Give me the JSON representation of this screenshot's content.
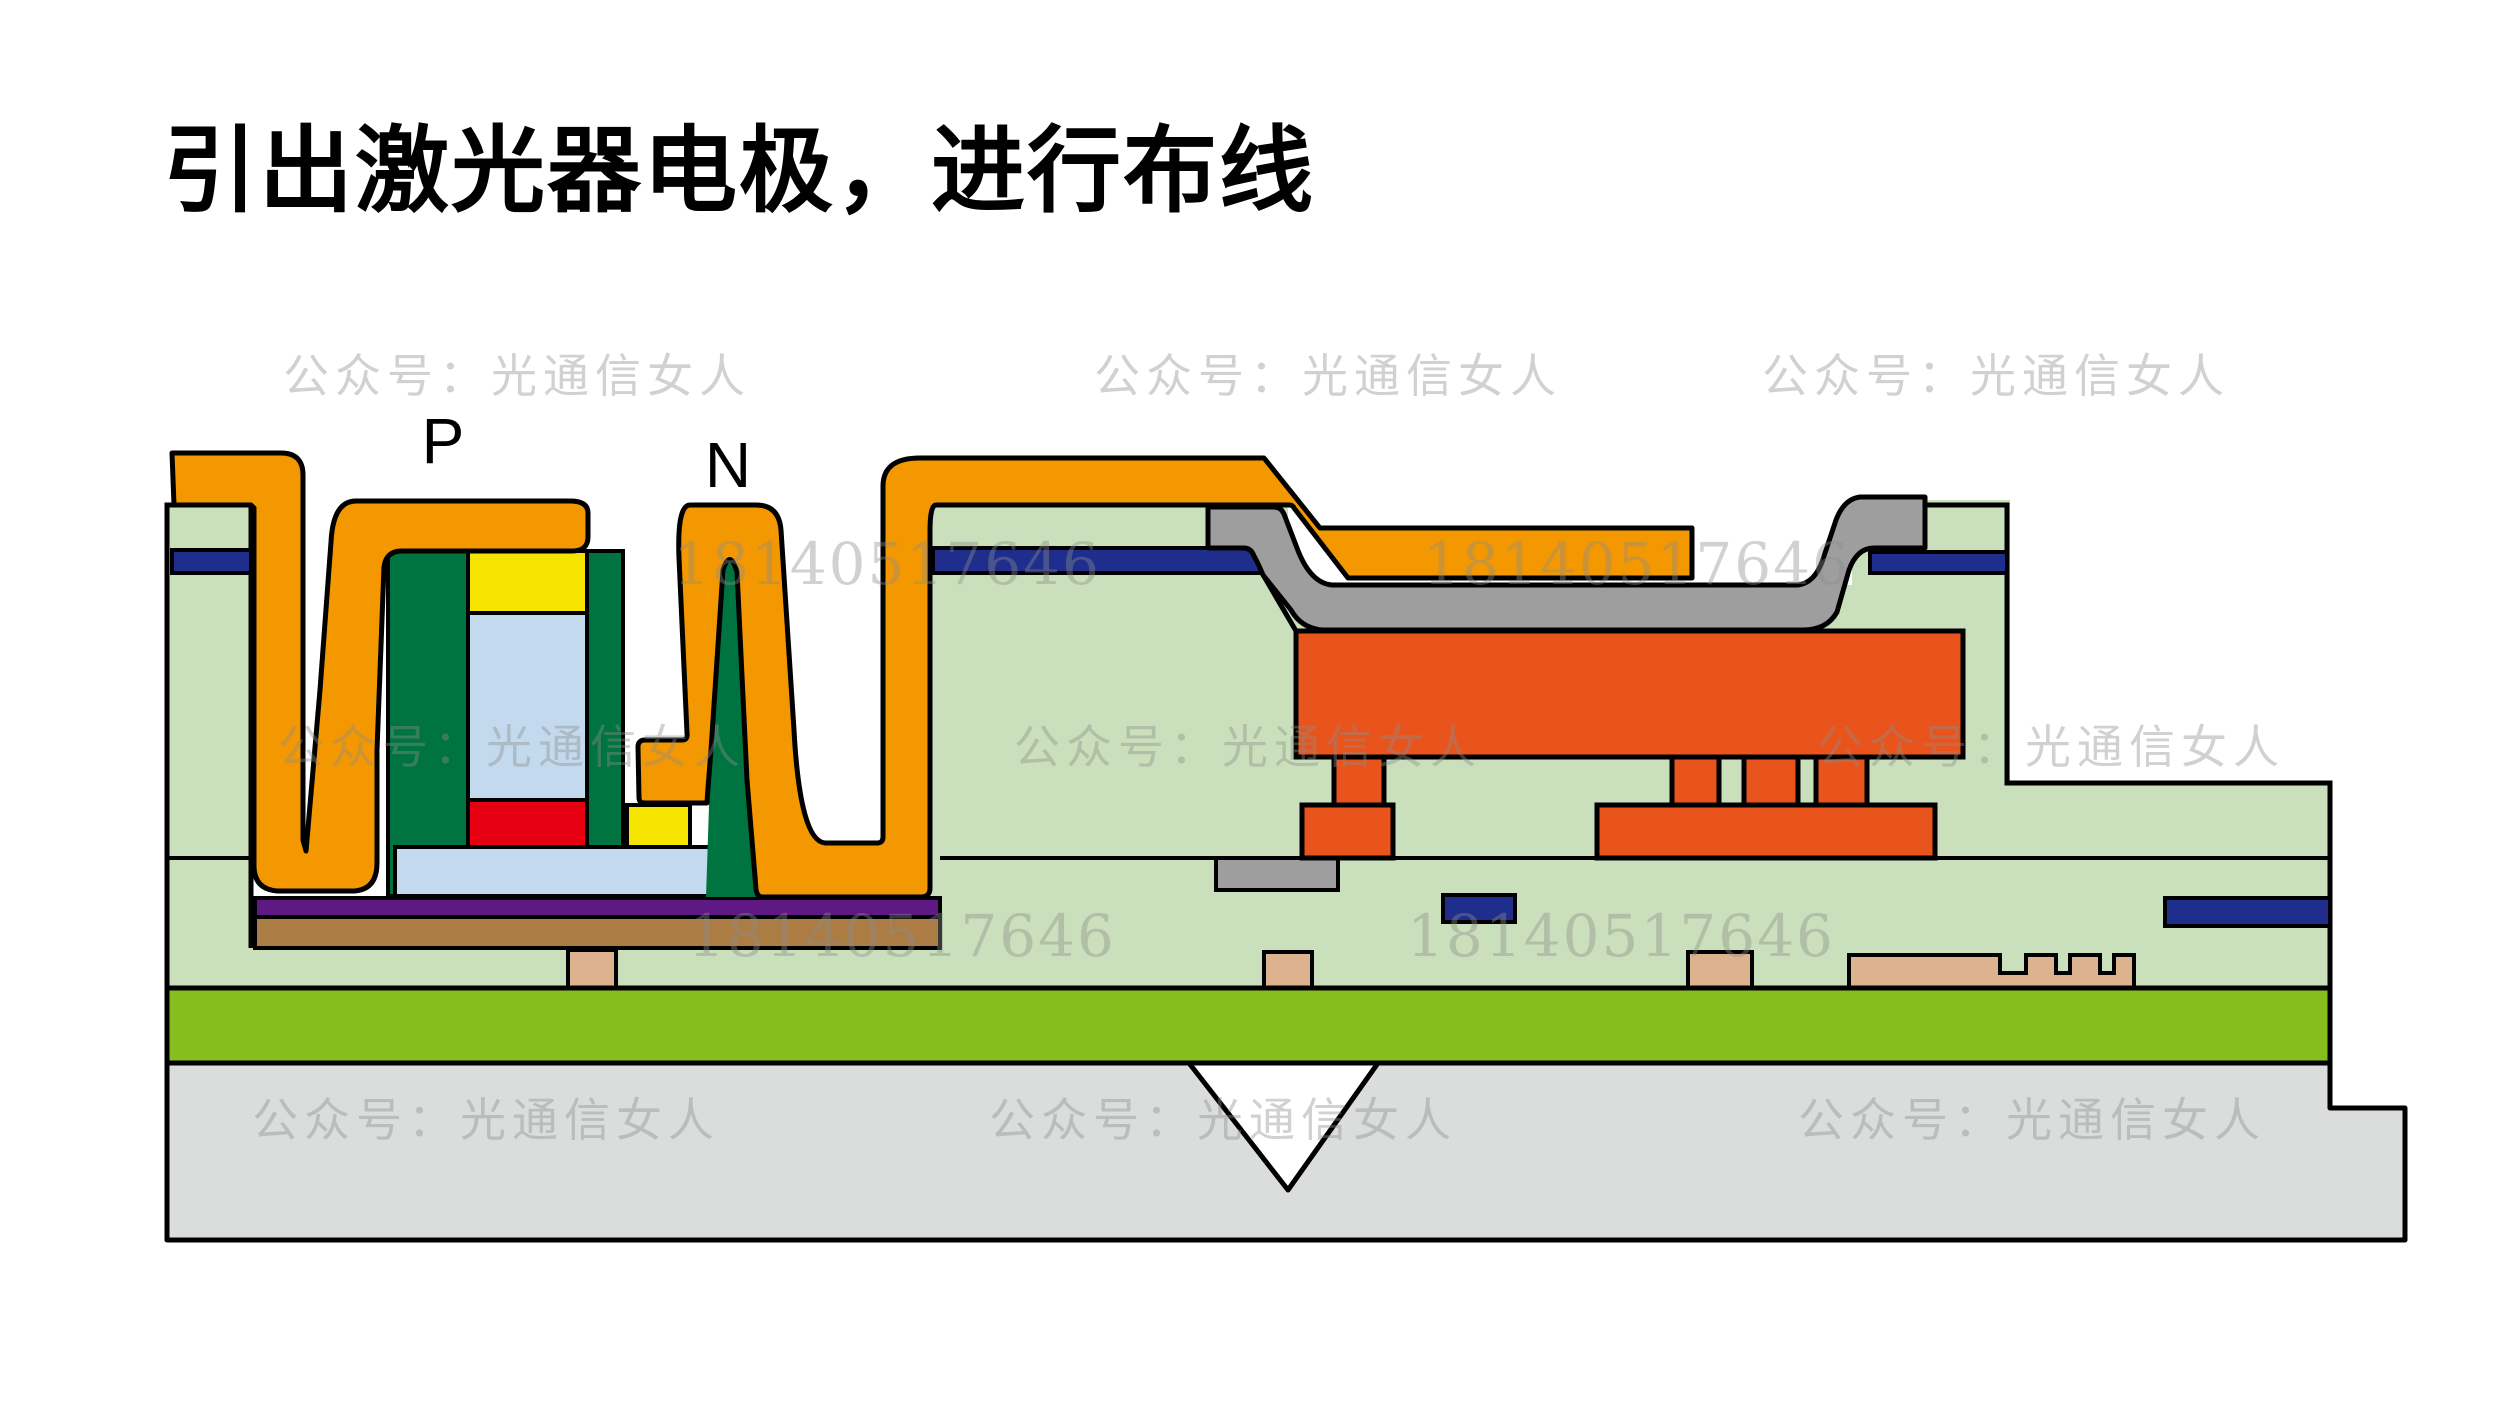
{
  "title": "引出激光器电极，进行布线",
  "labels": {
    "p": "P",
    "n": "N"
  },
  "watermarks": {
    "public_account": "公众号：光通信女人",
    "phone": "18140517646"
  },
  "colors": {
    "electrode_orange": "#F39800",
    "vermilion": "#E9541D",
    "epi_green": "#CADFBB",
    "bright_green": "#86BE1E",
    "dark_green": "#007440",
    "yellow": "#F5E400",
    "light_blue": "#C3DAEE",
    "red": "#E60012",
    "navy": "#1F2E8C",
    "purple": "#5F1985",
    "brown": "#AC7C45",
    "tan": "#DDB28E",
    "metal_gray": "#9E9E9F",
    "substrate_gray": "#DBDCDC",
    "white": "#FFFFFF",
    "outline": "#000000",
    "watermark_gray": "#8C8C8C",
    "title_black": "#000000"
  }
}
